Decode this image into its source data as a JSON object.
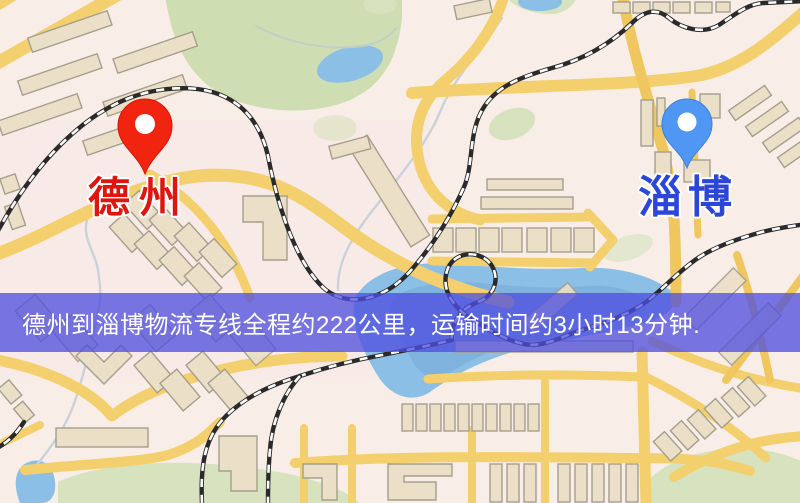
{
  "map_image": {
    "origin": {
      "label": "德州",
      "pin_color": "#f1240f",
      "label_color": "#e0150e"
    },
    "destination": {
      "label": "淄博",
      "pin_color": "#4f97f3",
      "label_color": "#2b46d8"
    },
    "banner": {
      "text": "德州到淄博物流专线全程约222公里，运输时间约3小时13分钟.",
      "background_color": "#4d4ddf",
      "text_color": "#ffffff",
      "route_from": "德州",
      "route_to": "淄博",
      "distance": "约222公里",
      "duration": "约3小时13分钟"
    },
    "palette": {
      "background": "#f8eee7",
      "road": "#f4cf6d",
      "building_fill": "#ebdfc8",
      "building_stroke": "#a59f8d",
      "park": "#d7e3bf",
      "water": "#8cbfe6",
      "railway_dark": "#2a2a2a",
      "railway_light": "#fdfdfd"
    }
  }
}
